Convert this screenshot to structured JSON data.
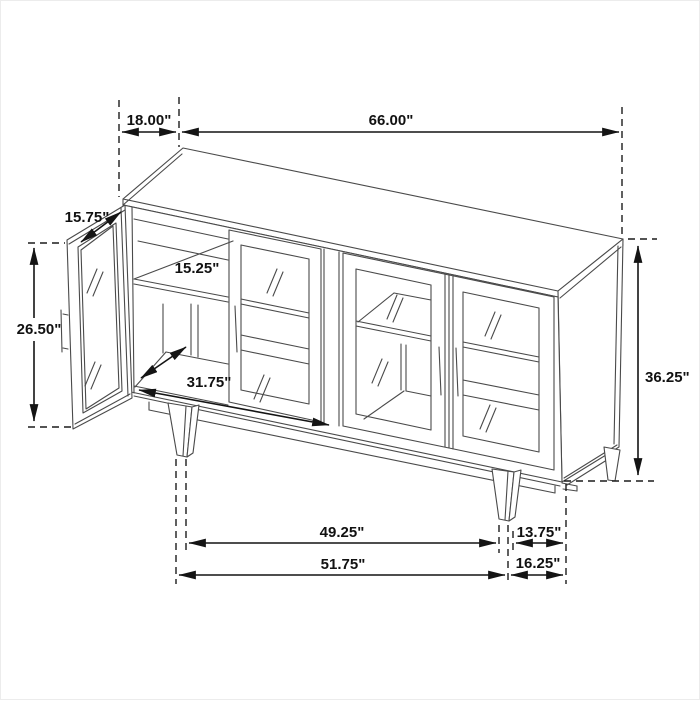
{
  "diagram": {
    "subject": "sideboard-cabinet-dimension-drawing",
    "dims": {
      "top_depth": "18.00\"",
      "overall_width": "66.00\"",
      "door_width": "15.75\"",
      "door_height": "26.50\"",
      "shelf_depth": "15.25\"",
      "interior_width": "31.75\"",
      "overall_height": "36.25\"",
      "leg_span": "49.25\"",
      "leg_inset_right": "13.75\"",
      "base_span": "51.75\"",
      "side_inset_right": "16.25\""
    },
    "colors": {
      "background": "#ffffff",
      "furniture_line": "#4a4a4a",
      "dimension_line": "#141414",
      "text": "#111111"
    }
  }
}
